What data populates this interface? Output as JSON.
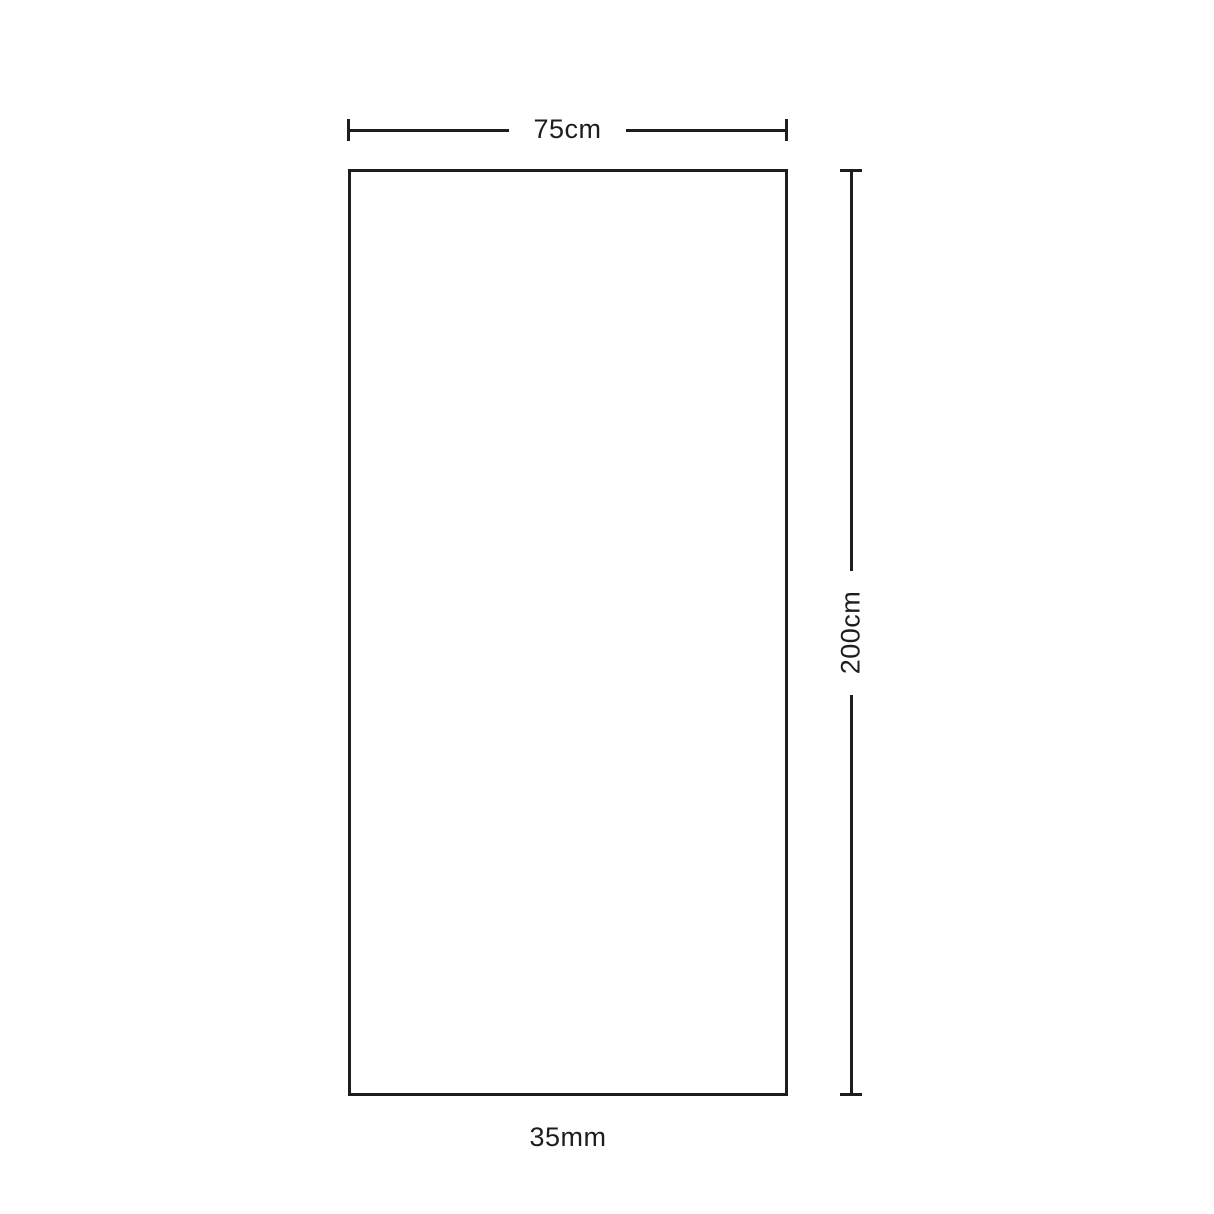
{
  "diagram": {
    "type": "product-dimension-diagram",
    "width_label": "75cm",
    "height_label": "200cm",
    "thickness_label": "35mm",
    "line_color": "#1d1d1b",
    "background_color": "#ffffff"
  }
}
